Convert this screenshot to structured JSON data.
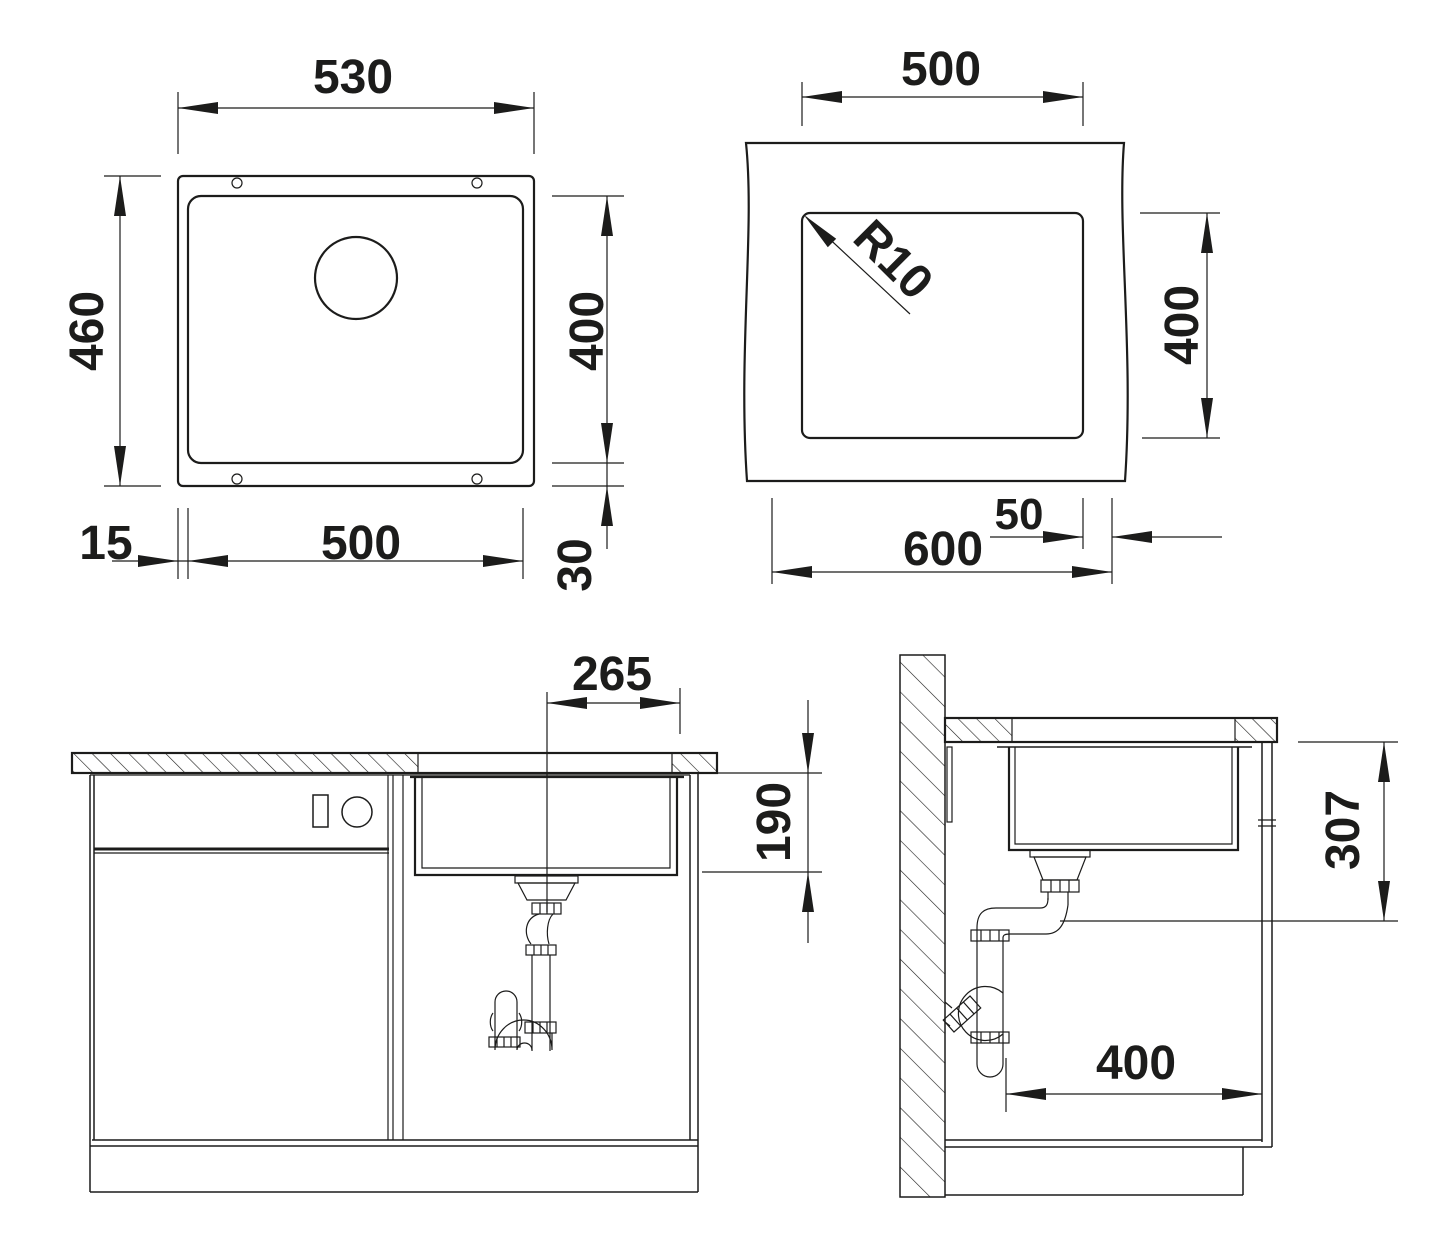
{
  "document": {
    "type": "technical-installation-drawing",
    "subject": "undermount kitchen sink with cabinet installation",
    "background_color": "#ffffff",
    "line_color": "#1c1c1b"
  },
  "views": {
    "sink_plan": {
      "name": "sink top view",
      "dims": {
        "width": "530",
        "depth": "460",
        "bowl_inner_depth": "400",
        "bowl_inner_width": "500",
        "rim_left": "15",
        "rim_bottom": "30"
      }
    },
    "worktop_cutout": {
      "name": "worktop cutout plan",
      "dims": {
        "cutout_width": "500",
        "corner_radius": "R10",
        "cutout_depth": "400",
        "min_distance": "50",
        "cabinet_width": "600"
      }
    },
    "front_elevation": {
      "name": "cabinet front elevation",
      "dims": {
        "center_to_edge": "265",
        "bowl_depth": "190"
      }
    },
    "side_section": {
      "name": "cabinet side section",
      "dims": {
        "outlet_height": "307",
        "clear_depth": "400"
      }
    }
  }
}
